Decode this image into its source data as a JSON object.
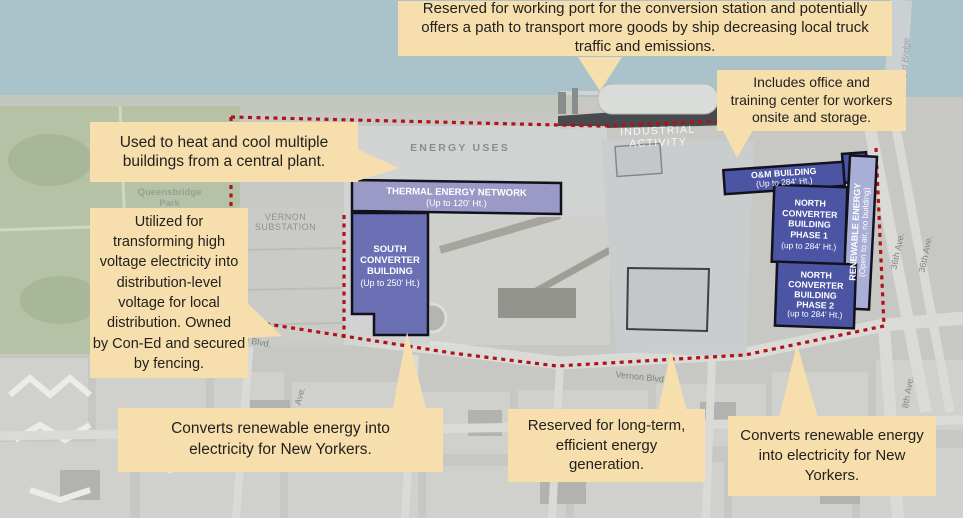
{
  "callouts": {
    "working_port": "Reserved for working port for the conversion station and potentially\noffers a path to transport more goods by ship decreasing local truck\ntraffic and emissions.",
    "office_training": "Includes office and\ntraining center for workers\nonsite and storage.",
    "heat_cool": "Used to heat and cool multiple\nbuildings from a central plant.",
    "substation": "Utilized for\ntransforming high\nvoltage electricity into\ndistribution-level\nvoltage for local\ndistribution. Owned\nby Con-Ed and secured\nby fencing.",
    "converts_south": "Converts renewable energy into\nelectricity for New Yorkers.",
    "long_term": "Reserved for long-term,\nefficient energy\ngeneration.",
    "converts_north": "Converts renewable energy\ninto  electricity for New\nYorkers."
  },
  "buildings": {
    "thermal": {
      "name": "THERMAL ENERGY NETWORK",
      "height": "(Up to 120' Ht.)"
    },
    "south_converter": {
      "name": "SOUTH\nCONVERTER\nBUILDING",
      "height": "(Up to 250' Ht.)"
    },
    "om": {
      "name": "O&M BUILDING",
      "height": "(Up to 284' Ht.)"
    },
    "north_converter_1": {
      "name": "NORTH\nCONVERTER\nBUILDING\nPHASE 1",
      "height": "(up to 284' Ht.)"
    },
    "north_converter_2": {
      "name": "NORTH\nCONVERTER\nBUILDING\nPHASE 2",
      "height": "(up to 284' Ht.)"
    },
    "renewable": {
      "name": "RENEWABLE ENERGY",
      "height": "(Open to air, no building)"
    }
  },
  "map_labels": {
    "energy_uses": "ENERGY USES",
    "industrial_activity": "INDUSTRIAL ACTIVITY",
    "queensbridge_park": "Queensbridge\nPark",
    "vernon_substation": "VERNON\nSUBSTATION",
    "vernon_blvd": "Vernon Blvd.",
    "vernon_blvd_fragment": "n Blvd.",
    "ave_fragment": "Ave.",
    "ave36_a": "36th Ave.",
    "ave36_b": "36th Ave.",
    "ave8": "8th Ave.",
    "island_bridge": "Island Bridge"
  },
  "colors": {
    "callout_bg": "#f7dfad",
    "boundary_red": "#b11217",
    "building_dark": "#4c55a4",
    "building_mid": "#6b70b5",
    "building_light": "#9b9ac7",
    "building_pale": "#a9aed6",
    "water": "#aac3cb",
    "park": "#b6c2a5"
  }
}
